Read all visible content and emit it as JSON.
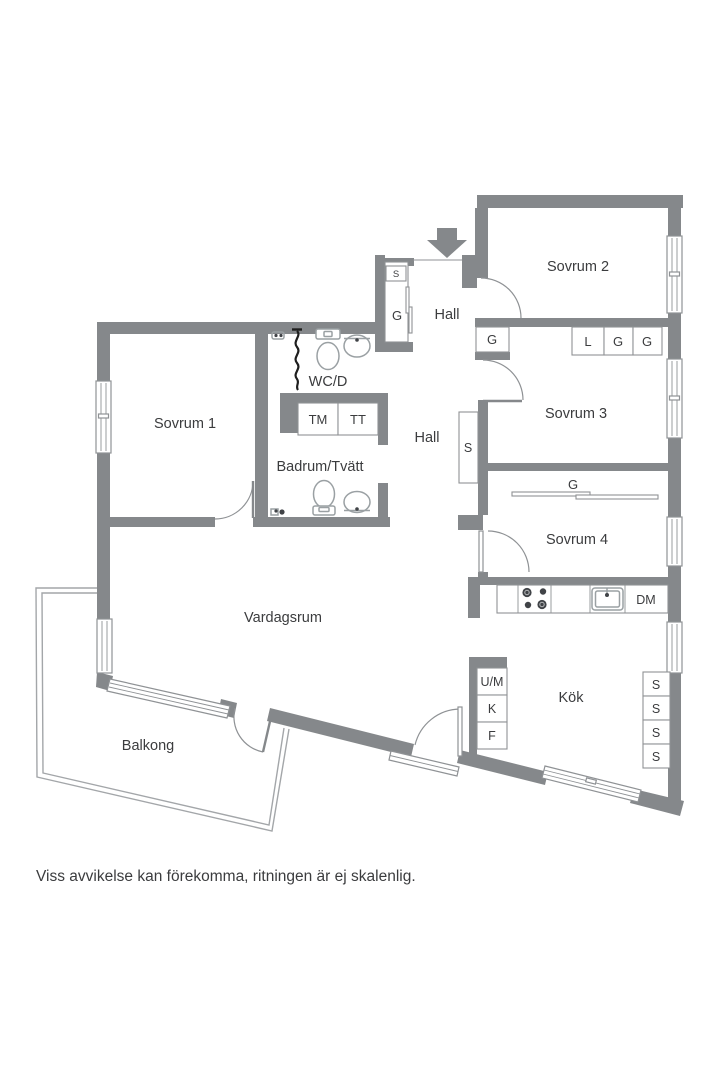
{
  "note": "Viss avvikelse kan förekomma, ritningen är ej skalenlig.",
  "colors": {
    "wall": "#85888b",
    "line": "#8f9295",
    "fixture": "#9aa0a3",
    "ink": "#3b3c3e",
    "dark": "#404347",
    "bg": "#ffffff"
  },
  "rooms": {
    "sovrum1": "Sovrum 1",
    "sovrum2": "Sovrum 2",
    "sovrum3": "Sovrum 3",
    "sovrum4": "Sovrum 4",
    "hall_upper": "Hall",
    "hall_lower": "Hall",
    "wc": "WC/D",
    "badrum": "Badrum/Tvätt",
    "vardagsrum": "Vardagsrum",
    "balkong": "Balkong",
    "kok": "Kök"
  },
  "storage": {
    "entry_shelf": "S",
    "entry_wardrobe": "G",
    "hall_wardrobe": "G",
    "sovrum2_row": [
      "L",
      "G",
      "G"
    ],
    "hall_closet": "S",
    "sovrum4_wardrobe": "G",
    "kitchen_tall": [
      "S",
      "S",
      "S",
      "S"
    ]
  },
  "appliances": {
    "tm": "TM",
    "tt": "TT",
    "dm": "DM",
    "um": "U/M",
    "k": "K",
    "f": "F"
  }
}
